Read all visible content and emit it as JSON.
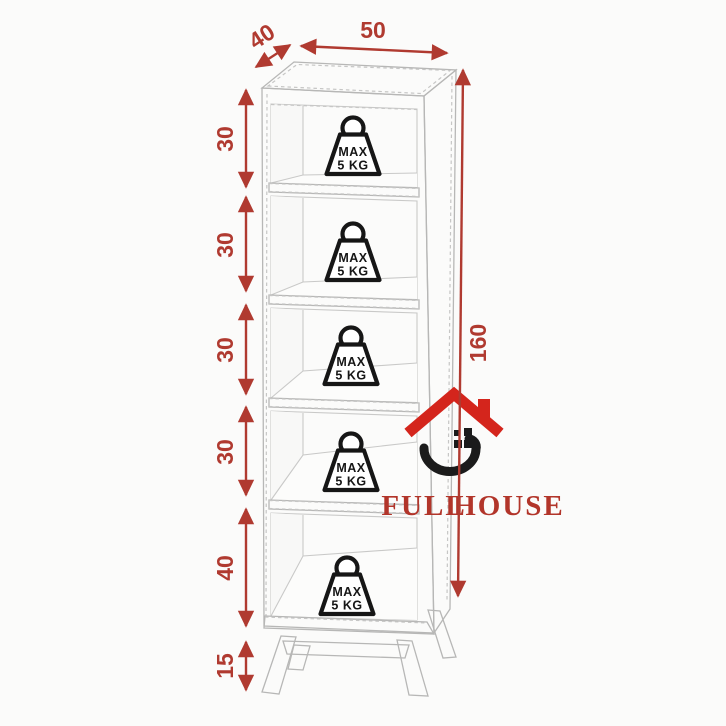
{
  "colors": {
    "background": "#fbfbfa",
    "dimension_red": "#b03a30",
    "logo_roof_red": "#d4251c",
    "logo_text_red": "#b2352a",
    "cabinet_line_gray": "#b7b7b6",
    "badge_black": "#161616"
  },
  "dimensions": {
    "top_width": "50",
    "top_depth": "40",
    "total_height": "160",
    "left_segments": [
      "30",
      "30",
      "30",
      "30",
      "40",
      "15"
    ]
  },
  "shelves": [
    {
      "badge_line1": "MAX",
      "badge_line2": "5 KG"
    },
    {
      "badge_line1": "MAX",
      "badge_line2": "5 KG"
    },
    {
      "badge_line1": "MAX",
      "badge_line2": "5 KG"
    },
    {
      "badge_line1": "MAX",
      "badge_line2": "5 KG"
    },
    {
      "badge_line1": "MAX",
      "badge_line2": "5 KG"
    }
  ],
  "logo": {
    "word1": "FULL",
    "word2": "HOUSE"
  }
}
